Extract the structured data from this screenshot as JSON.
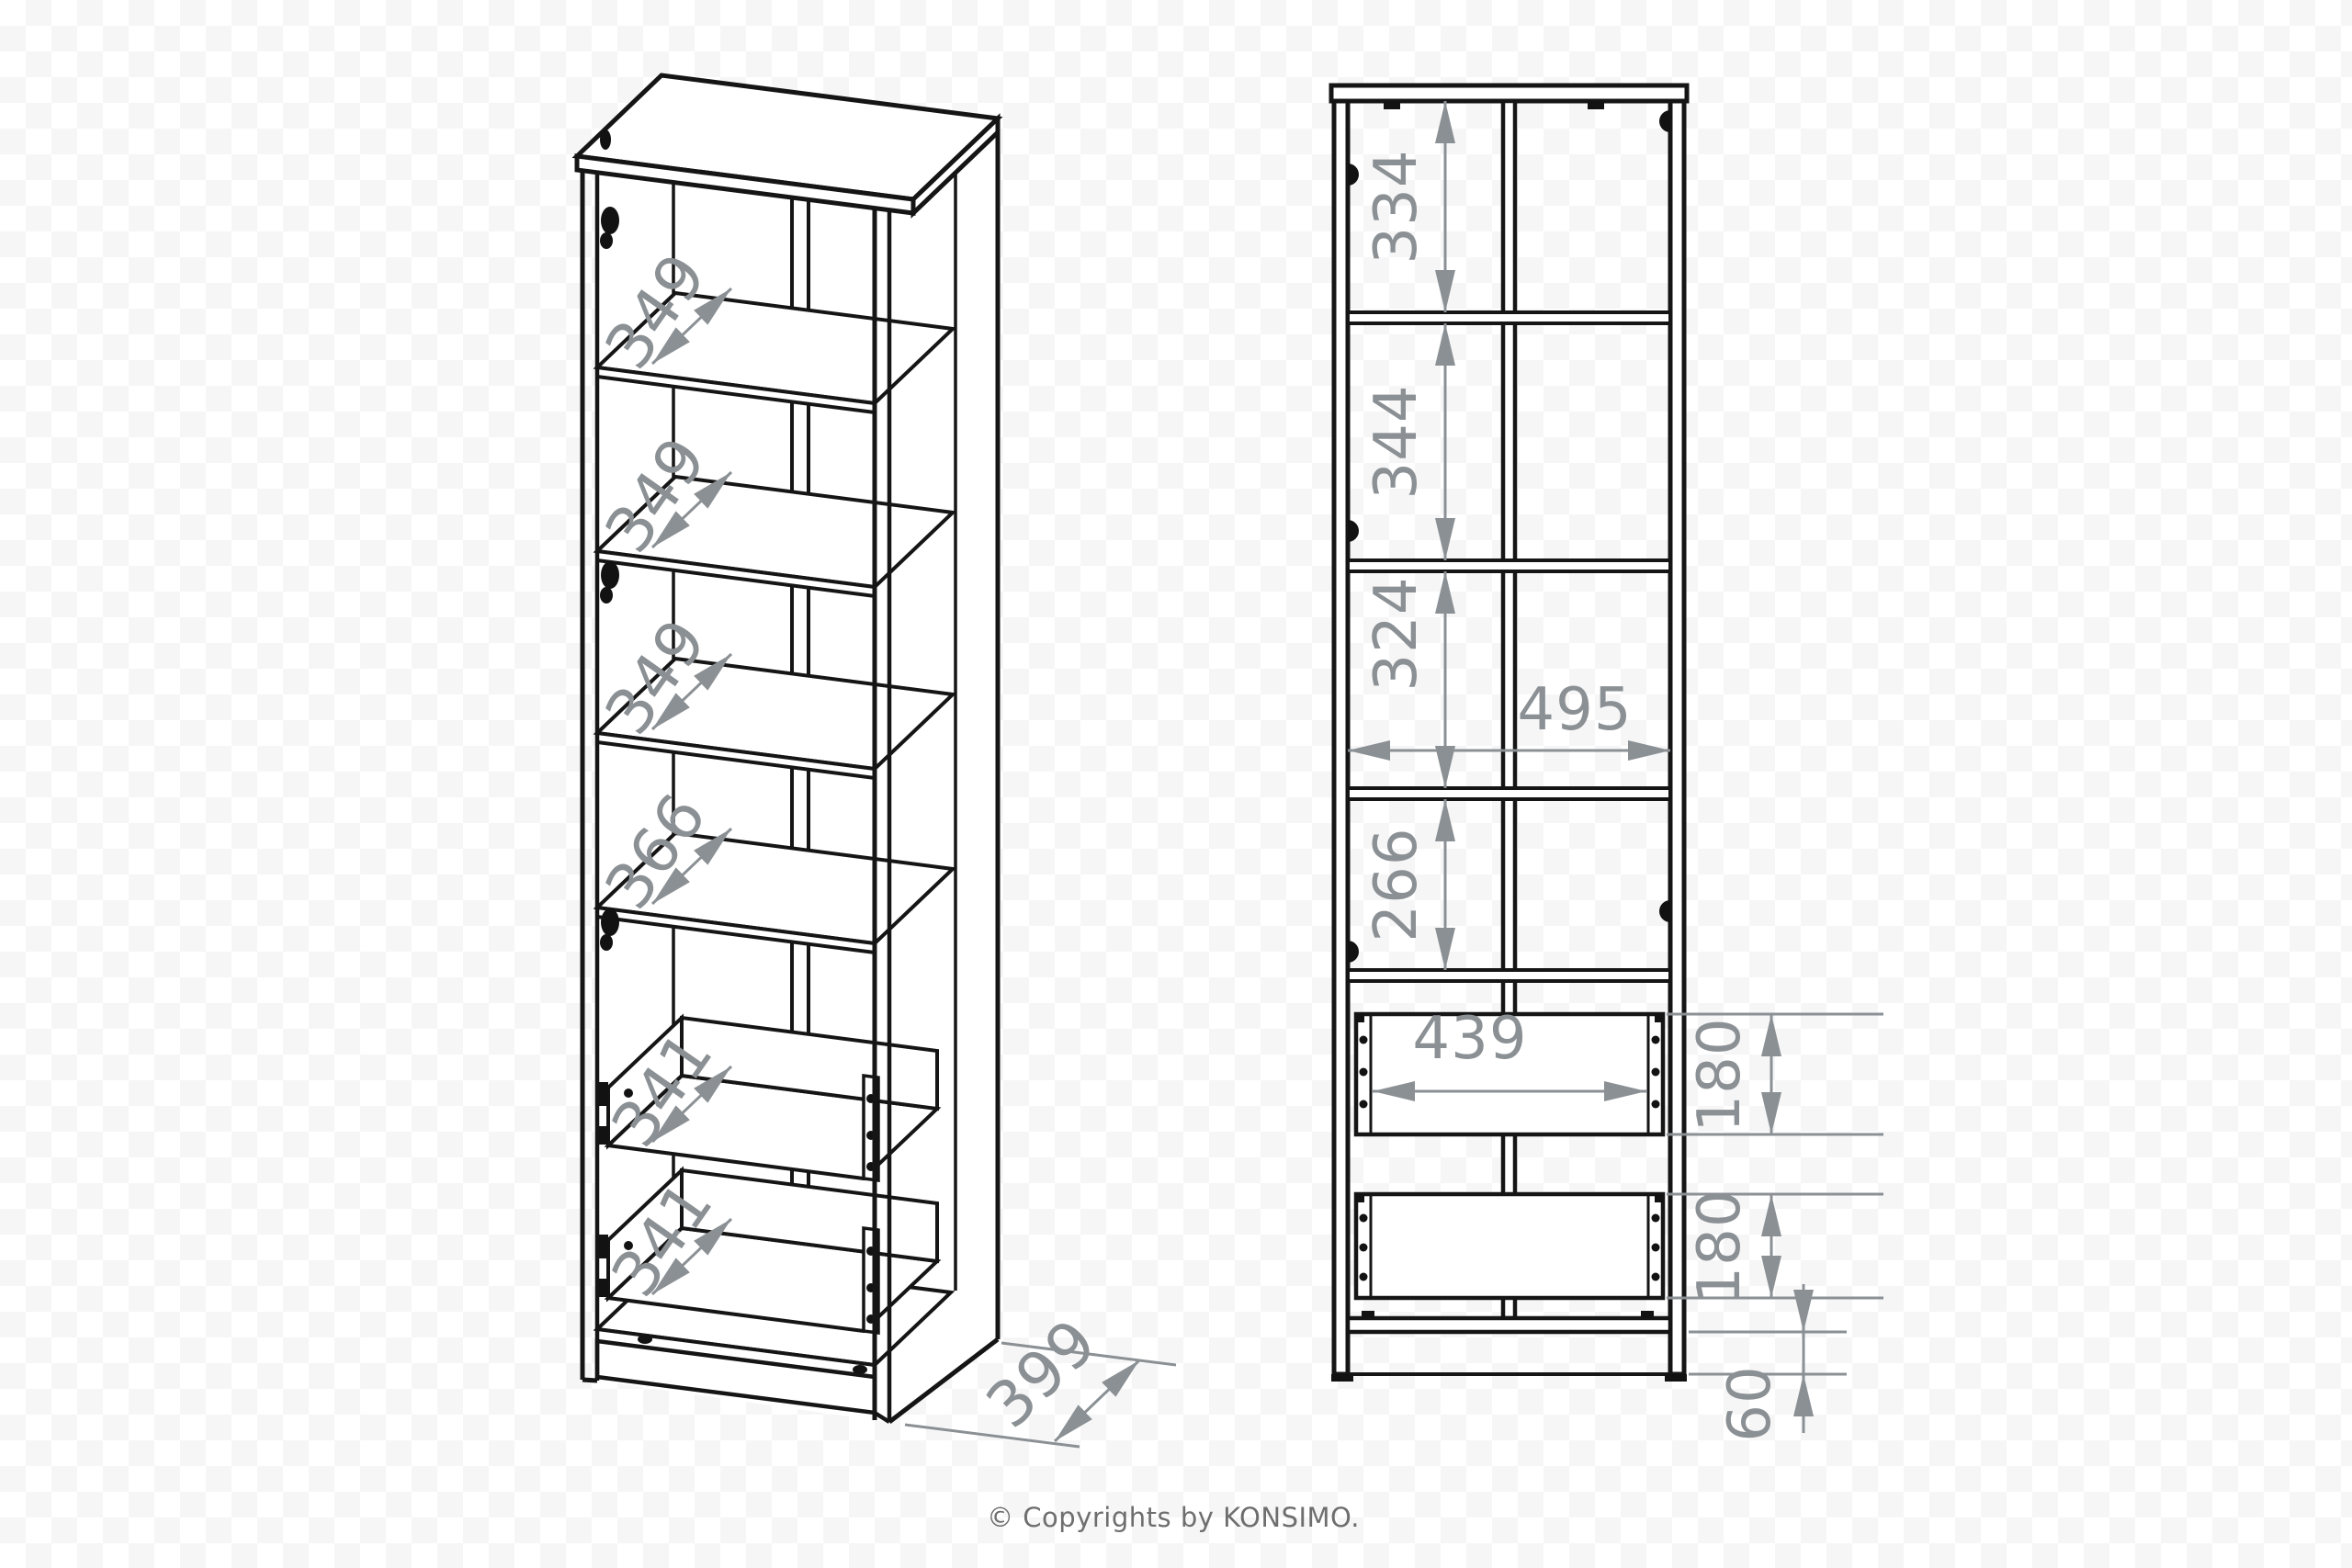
{
  "colors": {
    "line": "#151515",
    "dimension": "#8b9094",
    "copyright_text": "#6e6e6e",
    "background": "#ffffff",
    "background_checker": "#f6f6f7"
  },
  "views": {
    "perspective": {
      "shelf_dims": [
        "349",
        "349",
        "349",
        "366"
      ],
      "drawer_dims": [
        "341",
        "341"
      ],
      "depth_dim": "399"
    },
    "front": {
      "section_dims": [
        "334",
        "344",
        "324",
        "266"
      ],
      "inner_width_dim": "495",
      "drawer_width_dim": "439",
      "drawer_height_dims": [
        "180",
        "180"
      ],
      "plinth_dim": "60"
    }
  },
  "footer": {
    "copyright": "© Copyrights by KONSIMO."
  }
}
